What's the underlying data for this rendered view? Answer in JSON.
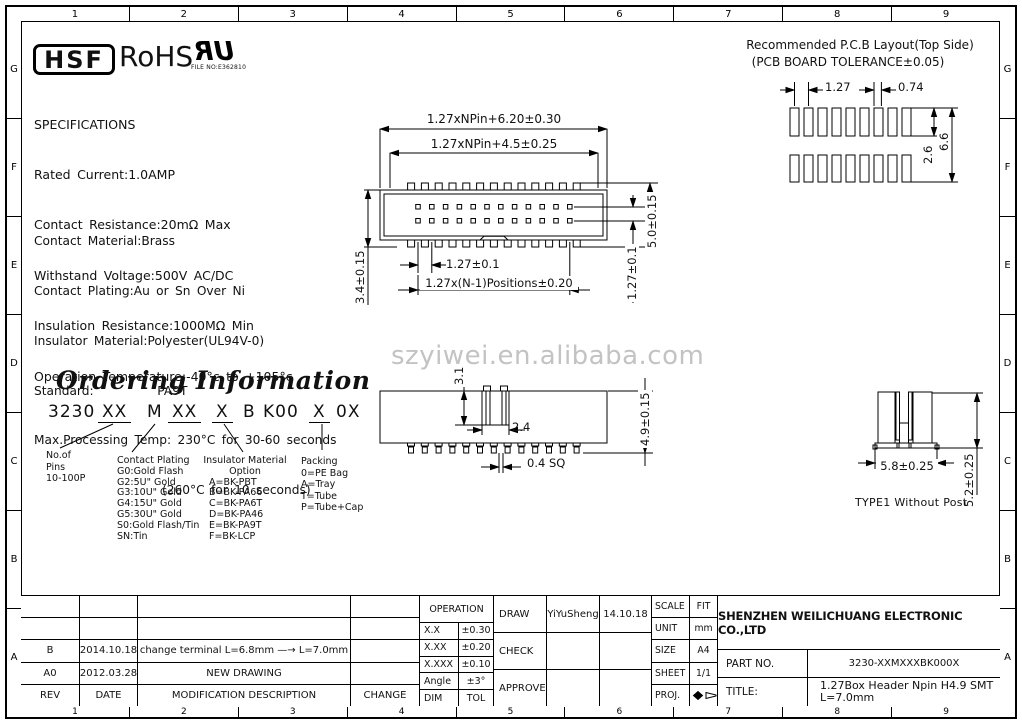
{
  "frame": {
    "columns": [
      "1",
      "2",
      "3",
      "4",
      "5",
      "6",
      "7",
      "8",
      "9"
    ],
    "rows": [
      "G",
      "F",
      "E",
      "D",
      "C",
      "B",
      "A"
    ]
  },
  "logos": {
    "hsf": "HSF",
    "rohs": "RoHS",
    "ul_mark": "UR",
    "ul_file_no": "FILE NO:E362810"
  },
  "specs": {
    "lines": [
      "SPECIFICATIONS",
      "Rated Current:1.0AMP",
      "Contact Resistance:20mΩ Max",
      "Withstand Voltage:500V AC/DC",
      "Insulation Resistance:1000MΩ Min",
      "Operation Temperature:-40°c to +105°c"
    ]
  },
  "materials": {
    "lines": [
      "Contact Material:Brass",
      "Contact Plating:Au or Sn Over Ni",
      "Insulator Material:Polyester(UL94V-0)",
      "Standard:          PA9T",
      "Max.Processing Temp: 230°C for 30-60 seconds",
      "(260°C for 10 seconds)"
    ]
  },
  "pcb_layout": {
    "title_line1": "Recommended P.C.B Layout(Top Side)",
    "title_line2": "(PCB BOARD TOLERANCE±0.05)",
    "dim_pitch": "1.27",
    "dim_pad_width": "0.74",
    "dim_pad_length": "2.6",
    "dim_span": "6.6"
  },
  "watermark": "szyiwei.en.alibaba.com",
  "top_view": {
    "dim_overall": "1.27xNPin+6.20±0.30",
    "dim_inner": "1.27xNPin+4.5±0.25",
    "dim_left_height": "3.4±0.15",
    "dim_right_height": "5.0±0.15",
    "dim_row_gap": "1.27±0.1",
    "dim_pitch": "1.27±0.1",
    "dim_positions": "1.27x(N-1)Positions±0.20"
  },
  "side_view": {
    "dim_key_height": "3.1",
    "dim_key_width": "2.4",
    "dim_pin_sq": "0.4 SQ",
    "dim_total_height": "4.9±0.15"
  },
  "section_view": {
    "dim_width": "5.8±0.25",
    "dim_height": "5.2±0.25",
    "caption": "TYPE1 Without Post"
  },
  "ordering": {
    "title": "Ordering Information",
    "part_tokens": [
      "3230",
      "XX",
      "M",
      "XX",
      "X",
      "B",
      "K00",
      "X",
      "0X"
    ],
    "pins": {
      "lines": [
        "No.of",
        "Pins",
        "10-100P"
      ]
    },
    "plating": {
      "lines": [
        "Contact Plating",
        "G0:Gold Flash",
        "G2:5U\" Gold",
        "G3:10U\" Gold",
        "G4:15U\" Gold",
        "G5:30U\" Gold",
        "S0:Gold Flash/Tin",
        "SN:Tin"
      ]
    },
    "insulator": {
      "lines": [
        "Insulator Material",
        "Option",
        "A=BK-PBT",
        "B=BK-PA66",
        "C=BK-PA6T",
        "D=BK-PA46",
        "E=BK-PA9T",
        "F=BK-LCP"
      ]
    },
    "packing": {
      "lines": [
        "Packing",
        "0=PE Bag",
        "A=Tray",
        "T=Tube",
        "P=Tube+Cap"
      ]
    }
  },
  "title_block": {
    "revisions": {
      "rows": [
        {
          "rev": "B",
          "date": "2014.10.18",
          "desc": "change terminal L=6.8mm —→ L=7.0mm",
          "change": ""
        },
        {
          "rev": "A0",
          "date": "2012.03.28",
          "desc": "NEW DRAWING",
          "change": ""
        }
      ],
      "headers": {
        "rev": "REV",
        "date": "DATE",
        "desc": "MODIFICATION DESCRIPTION",
        "change": "CHANGE"
      }
    },
    "tolerance": {
      "header": "OPERATION",
      "rows": [
        [
          "X.X",
          "±0.30"
        ],
        [
          "X.XX",
          "±0.20"
        ],
        [
          "X.XXX",
          "±0.10"
        ],
        [
          "Angle",
          "±3°"
        ],
        [
          "DIM",
          "TOL"
        ]
      ]
    },
    "signoff": {
      "draw_label": "DRAW",
      "draw_name": "YiYuSheng",
      "draw_date": "14.10.18",
      "check_label": "CHECK",
      "approve_label": "APPROVE"
    },
    "info": {
      "scale_label": "SCALE",
      "scale": "FIT",
      "unit_label": "UNIT",
      "unit": "mm",
      "size_label": "SIZE",
      "size": "A4",
      "sheet_label": "SHEET",
      "sheet": "1/1",
      "proj_label": "PROJ."
    },
    "company": "SHENZHEN WEILICHUANG ELECTRONIC CO.,LTD",
    "part_no_label": "PART NO.",
    "part_no": "3230-XXMXXXBK000X",
    "title_label": "TITLE:",
    "title_line1": "1.27Box Header Npin H4.9 SMT",
    "title_line2": "L=7.0mm"
  }
}
